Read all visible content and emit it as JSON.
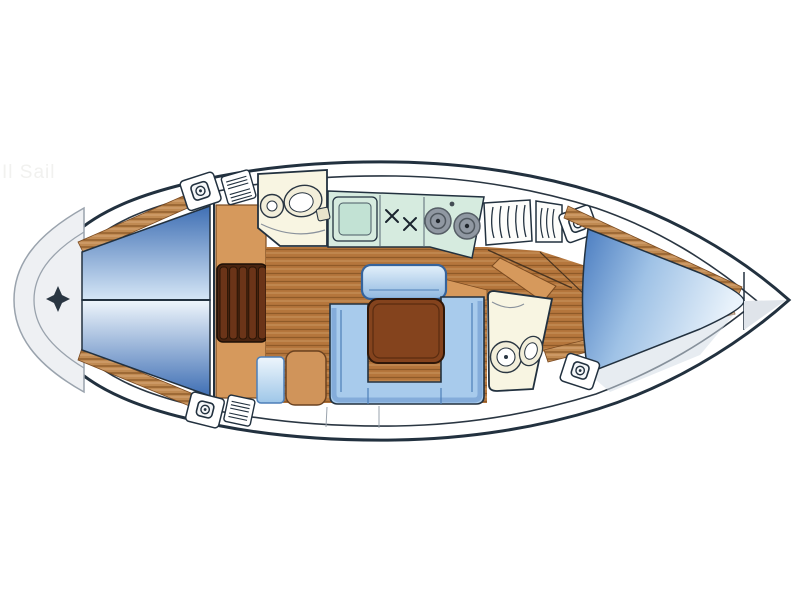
{
  "page": {
    "background": "#ffffff",
    "watermark_text": "Il Sail",
    "title": "Sailing yacht interior layout floor plan, bow to the right"
  },
  "palette": {
    "outline": "#22313f",
    "deck_white": "#ffffff",
    "transom_grey": "#eef0f3",
    "transom_border": "#9aa3ad",
    "berth_blue_dark": "#3f6fb4",
    "berth_blue_light": "#eaf3fb",
    "settee_blue": "#a8cbec",
    "settee_border": "#35639c",
    "bench_blue": "#8fb8e0",
    "table_brown": "#84431d",
    "wood_floor": "#b5763c",
    "wood_plank_line": "#8f5a28",
    "wood_trim": "#c08a52",
    "cabinet_tan": "#d6995c",
    "steps_dark_brown": "#5e3014",
    "galley_teal": "#d6ebdf",
    "head_cream": "#f8f5e2",
    "burner_grey": "#9098a2",
    "shade_grey_blue": "#d3dce6"
  },
  "diagram": {
    "type": "sailboat-interior-floor-plan",
    "orientation": "bow-right, stern-left",
    "areas": [
      {
        "id": "swim-platform",
        "desc": "rounded grey transom arcs with four-point star marker"
      },
      {
        "id": "aft-cabin",
        "desc": "athwartships double berth split into two blue cushions"
      },
      {
        "id": "companionway-steps",
        "desc": "dark wooden steps with five treads"
      },
      {
        "id": "wardrobe-cabinet",
        "desc": "tan cabinet column beside the steps"
      },
      {
        "id": "port-head",
        "desc": "washroom with round basin and toilet"
      },
      {
        "id": "galley",
        "desc": "teal counter with sink, two-burner stove and two round hobs"
      },
      {
        "id": "saloon",
        "desc": "U-shaped settee, side bench and brown dining table on plank floor"
      },
      {
        "id": "nav-station",
        "desc": "tan seat with blue chart panel"
      },
      {
        "id": "starboard-head",
        "desc": "washroom with toilet bowl and oval basin"
      },
      {
        "id": "forward-cabin",
        "desc": "blue V-berth tapering into the bow"
      },
      {
        "id": "deck-hatches",
        "count": 4
      },
      {
        "id": "vent-grilles",
        "count": 2
      },
      {
        "id": "louvered-lockers",
        "count": 2
      }
    ]
  }
}
